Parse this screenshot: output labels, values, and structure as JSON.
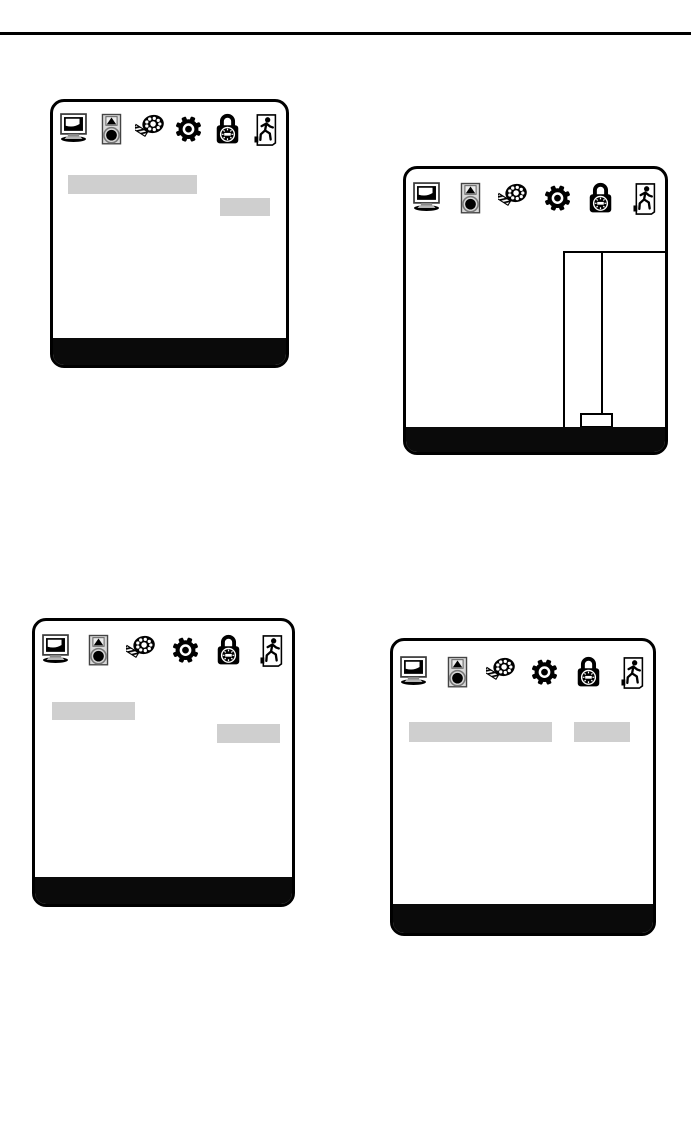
{
  "colors": {
    "page-bg": "#ffffff",
    "rule": "#000000",
    "panel-border": "#000000",
    "panel-bg": "#ffffff",
    "highlight": "#cfcfcf",
    "footer": "#0a0a0a"
  },
  "osd_menu": {
    "icons": [
      {
        "name": "monitor-icon",
        "symbol": "sym-monitor"
      },
      {
        "name": "speaker-icon",
        "symbol": "sym-speaker"
      },
      {
        "name": "color-palette-icon",
        "symbol": "sym-palette"
      },
      {
        "name": "gear-icon",
        "symbol": "sym-gear"
      },
      {
        "name": "lock-icon",
        "symbol": "sym-lock"
      },
      {
        "name": "exit-icon",
        "symbol": "sym-exit"
      }
    ]
  },
  "panels": [
    {
      "name": "osd-panel-top-left",
      "parts": [
        "menu-bar",
        "selected-item-highlight",
        "value-box",
        "footer-bar"
      ]
    },
    {
      "name": "osd-panel-top-right",
      "parts": [
        "menu-bar",
        "slider-panel",
        "slider-track",
        "slider-handle",
        "footer-bar"
      ]
    },
    {
      "name": "osd-panel-bottom-left",
      "parts": [
        "menu-bar",
        "selected-item-highlight",
        "value-box",
        "footer-bar"
      ]
    },
    {
      "name": "osd-panel-bottom-right",
      "parts": [
        "menu-bar",
        "selected-item-highlight",
        "value-box",
        "footer-bar"
      ]
    }
  ]
}
